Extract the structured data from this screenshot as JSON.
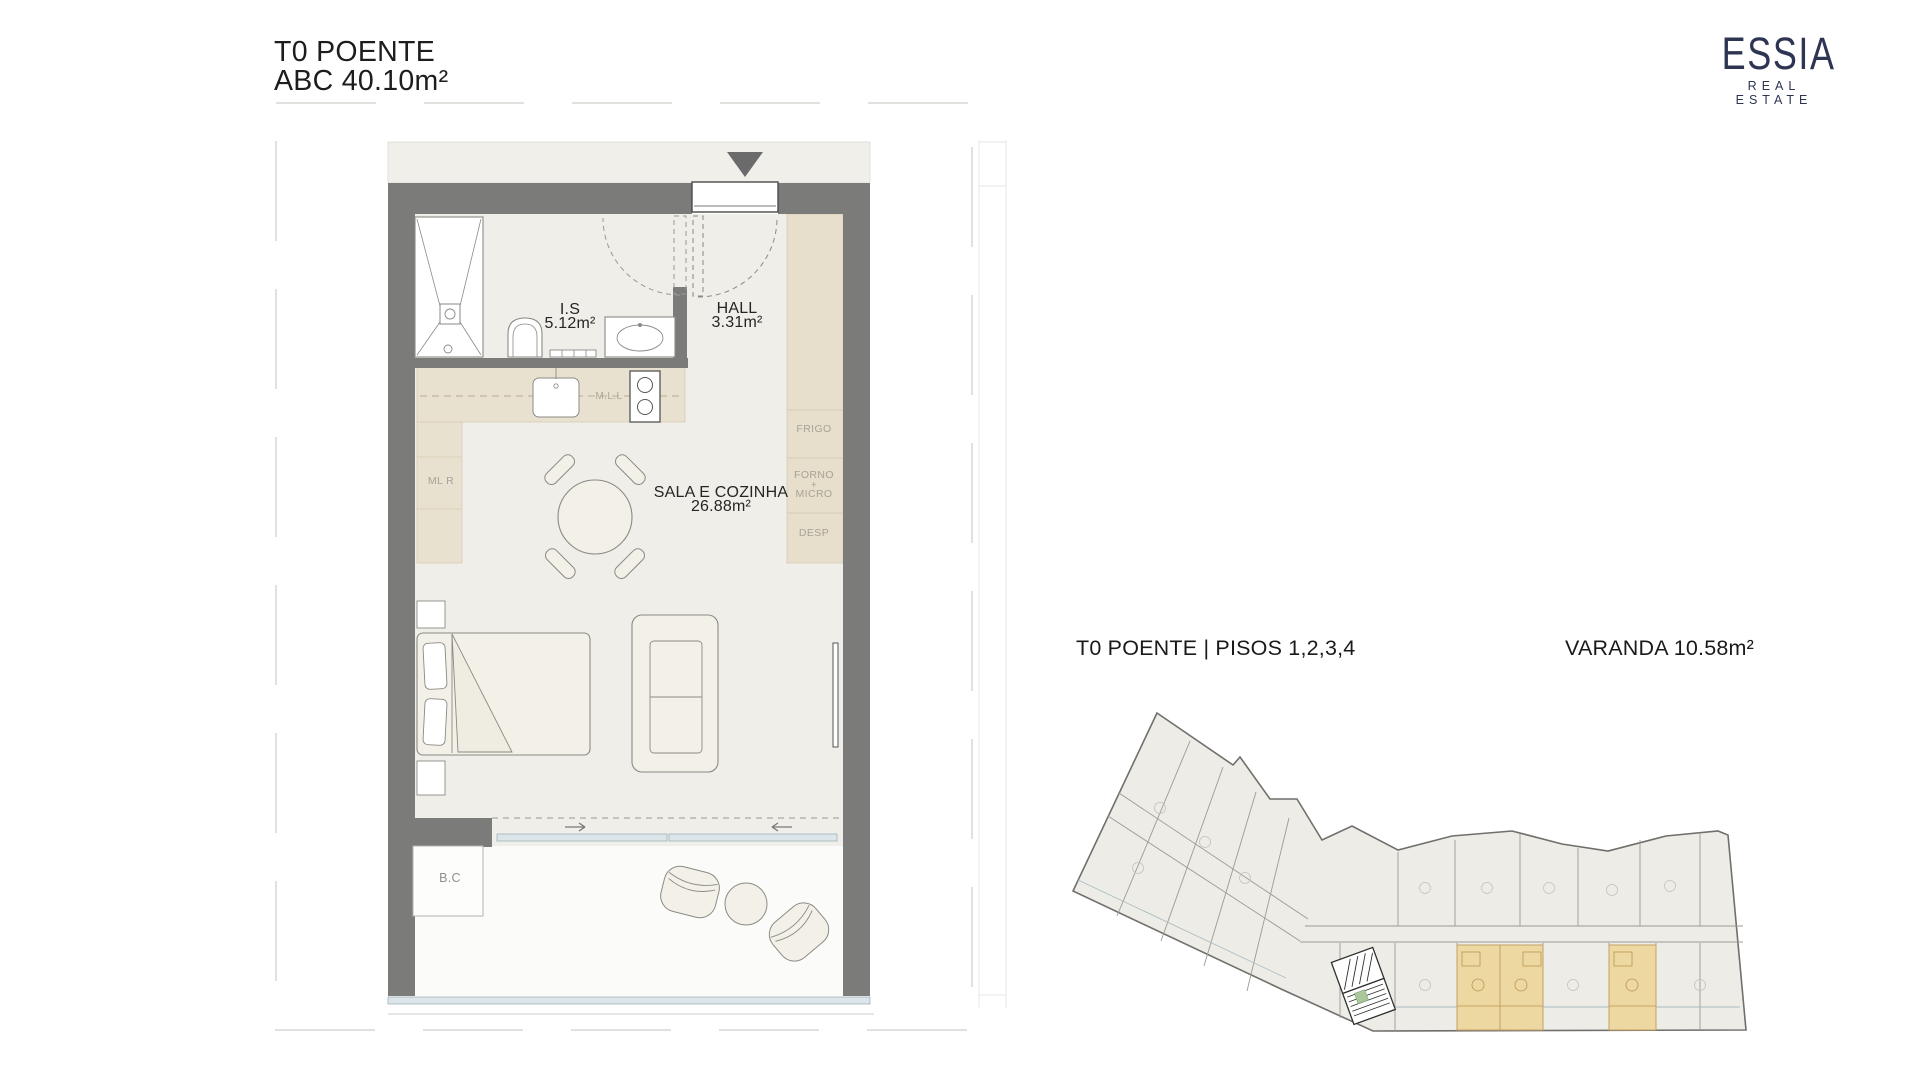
{
  "header": {
    "title_line1": "T0 POENTE",
    "title_line2": "ABC 40.10m²"
  },
  "logo": {
    "brand": "ESSIA",
    "tagline": "REAL ESTATE"
  },
  "floor_plan": {
    "rooms": {
      "is": {
        "name": "I.S",
        "area": "5.12m²"
      },
      "hall": {
        "name": "HALL",
        "area": "3.31m²"
      },
      "sala": {
        "name": "SALA E COZINHA",
        "area": "26.88m²"
      }
    },
    "labels": {
      "ml_l": "M.L.L",
      "ml_r": "ML R",
      "frigo": "FRIGO",
      "forno": "FORNO",
      "forno_plus": "+",
      "micro": "MICRO",
      "desp": "DESP",
      "bc": "B.C"
    }
  },
  "key_plan": {
    "caption": "T0 POENTE | PISOS 1,2,3,4",
    "varanda": "VARANDA 10.58m²"
  },
  "colors": {
    "wall_gray": "#7b7b7a",
    "floor": "#efeee8",
    "cabinet_tan": "#e9e1cf",
    "highlight_tan": "#edd8a2",
    "glass_blue": "#dce6ea",
    "logo_navy": "#2e3553",
    "label_gray": "#a6a298"
  }
}
